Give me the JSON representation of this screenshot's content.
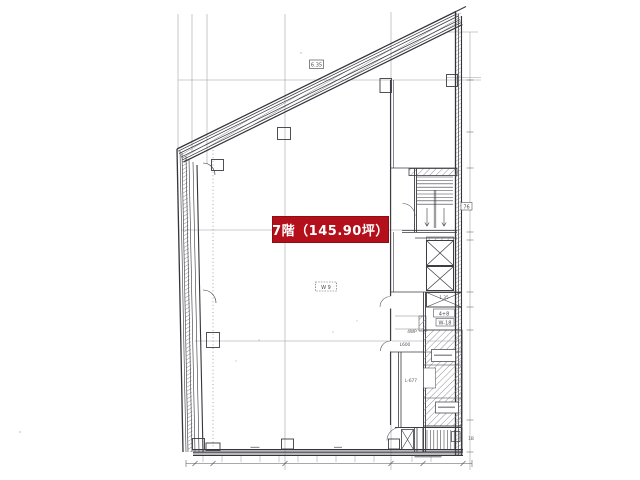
{
  "document": {
    "kind": "architectural floor plan (scanned)",
    "badge": {
      "label": "7階（145.90坪）",
      "bg_color": "#b3101b",
      "text_color": "#ffffff"
    }
  },
  "plan": {
    "tiny_labels": [
      {
        "text": "6.35"
      },
      {
        "text": "W 9"
      },
      {
        "text": "76"
      },
      {
        "text": "1.35"
      },
      {
        "text": "4+8"
      },
      {
        "text": "W-18"
      },
      {
        "text": "4WP"
      },
      {
        "text": "L600"
      },
      {
        "text": "L-677"
      },
      {
        "text": "1B"
      }
    ],
    "line_color": "#47474d",
    "grid_color": "#9b9ba1"
  }
}
